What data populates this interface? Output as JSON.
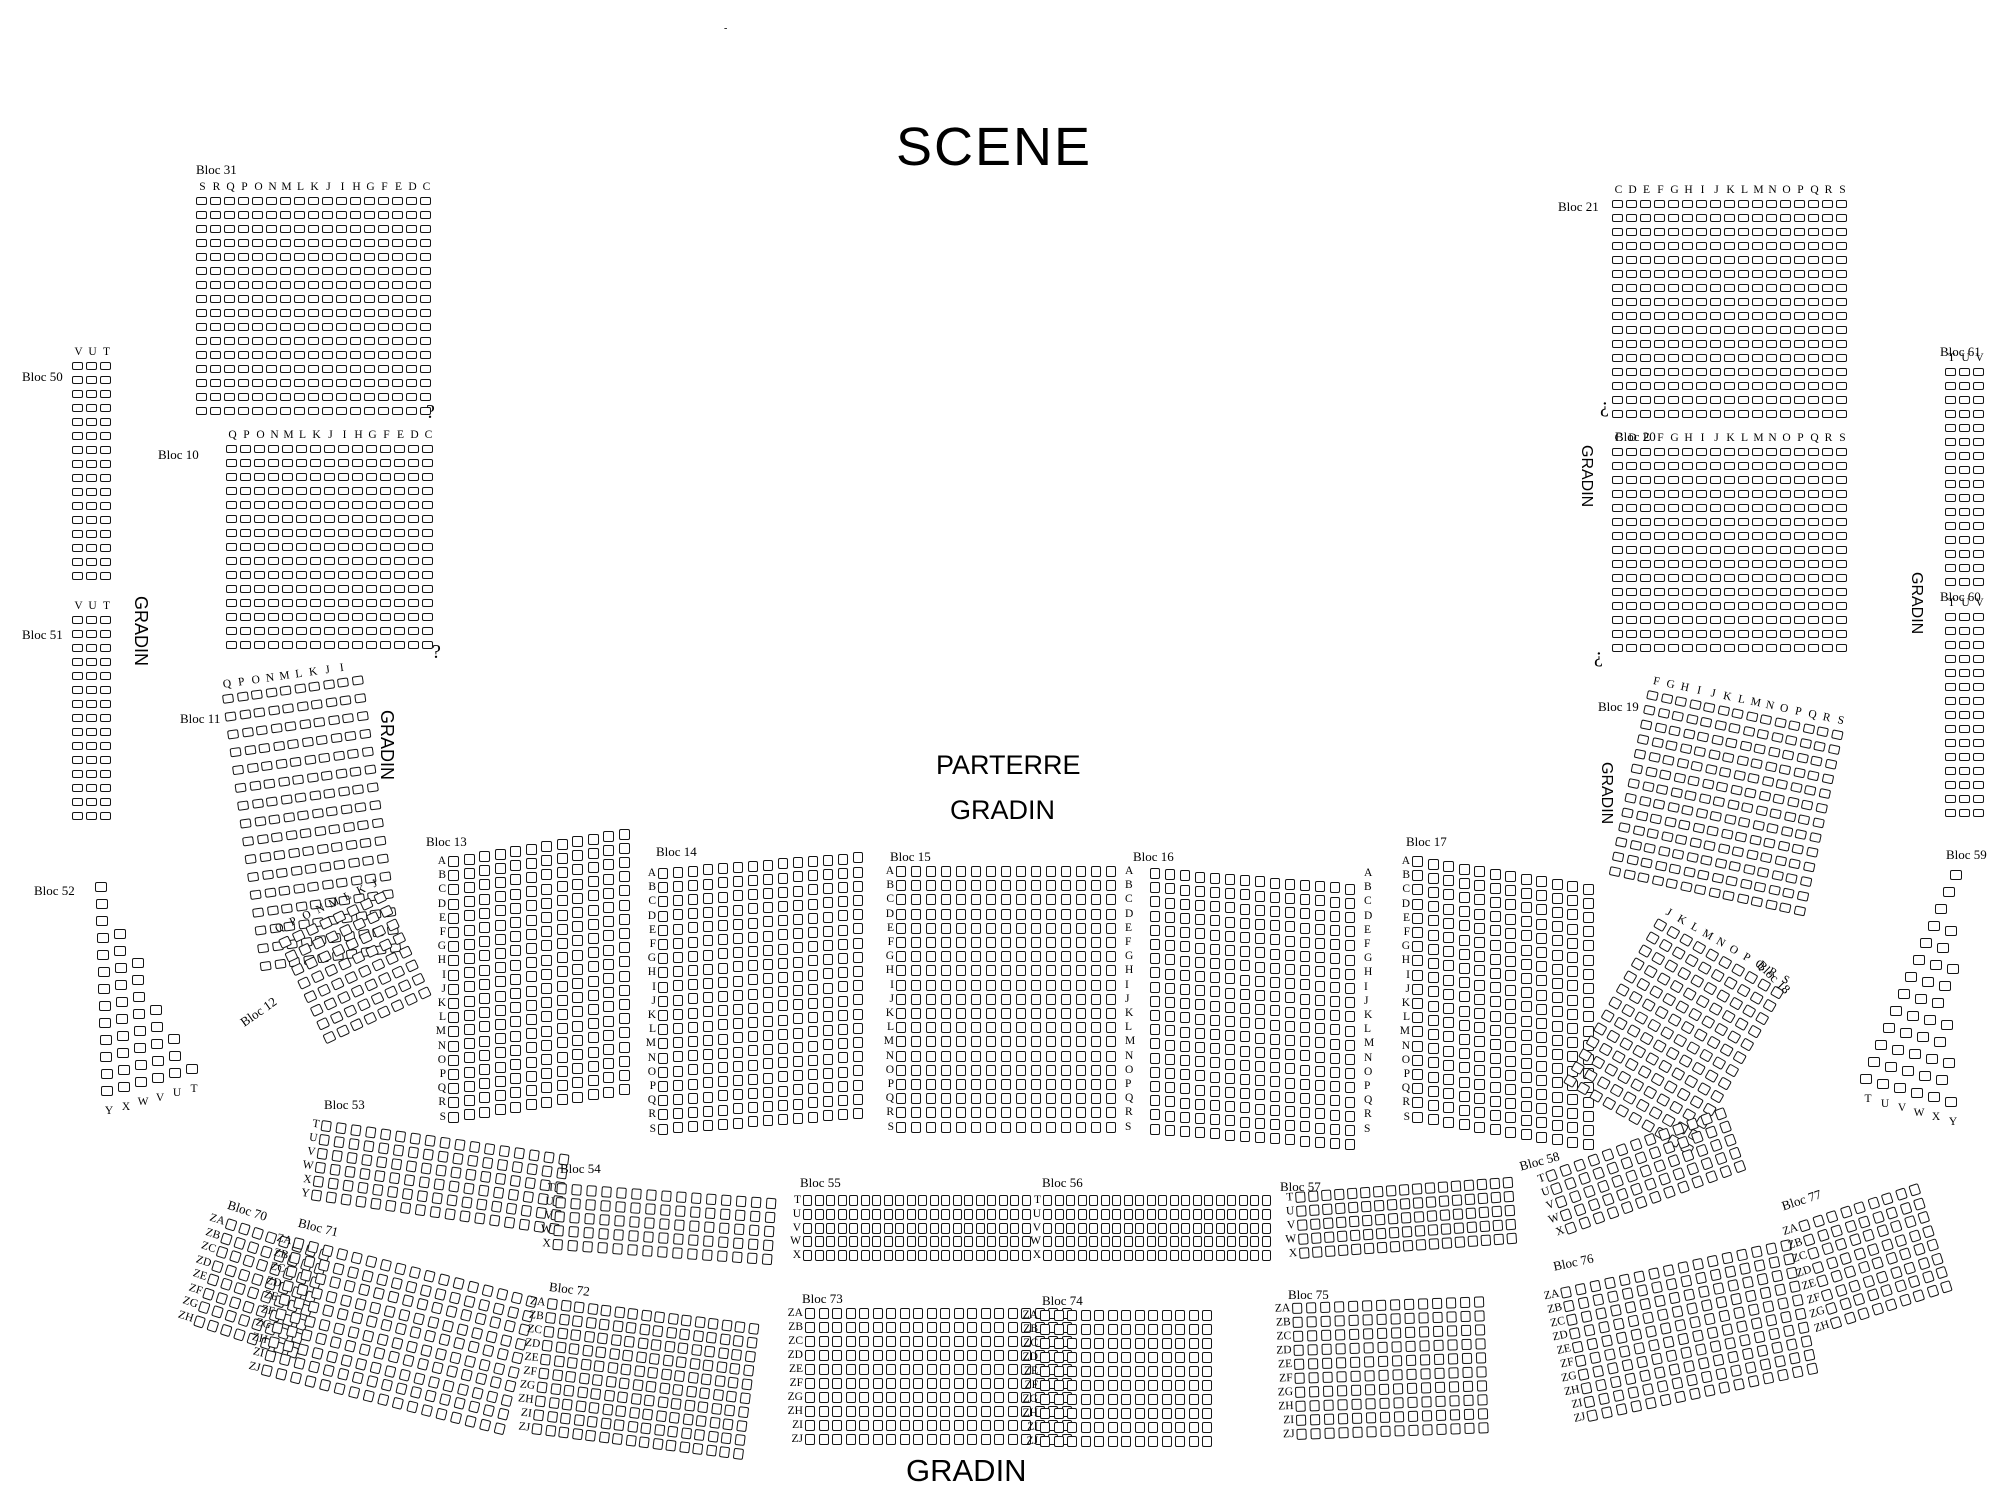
{
  "title": "SCENE",
  "texts": [
    {
      "id": "scene-title",
      "text": "SCENE",
      "x": 896,
      "y": 120,
      "size": 54,
      "sans": true,
      "ls": 2
    },
    {
      "id": "parterre-label",
      "text": "PARTERRE",
      "x": 936,
      "y": 752,
      "size": 27,
      "sans": true
    },
    {
      "id": "gradin-center-label",
      "text": "GRADIN",
      "x": 950,
      "y": 797,
      "size": 27,
      "sans": true
    },
    {
      "id": "gradin-bottom-label",
      "text": "GRADIN",
      "x": 906,
      "y": 1455,
      "size": 31,
      "sans": true
    },
    {
      "id": "gradin-left-vertical-1",
      "text": "GRADIN",
      "x": 150,
      "y": 596,
      "size": 18,
      "sans": true,
      "rot": 90
    },
    {
      "id": "gradin-left-vertical-2",
      "text": "GRADIN",
      "x": 396,
      "y": 710,
      "size": 18,
      "sans": true,
      "rot": 90
    },
    {
      "id": "gradin-right-vertical-1",
      "text": "GRADIN",
      "x": 1594,
      "y": 445,
      "size": 16,
      "sans": true,
      "rot": 90
    },
    {
      "id": "gradin-right-vertical-2",
      "text": "GRADIN",
      "x": 1614,
      "y": 762,
      "size": 16,
      "sans": true,
      "rot": 90
    },
    {
      "id": "gradin-far-right-vertical",
      "text": "GRADIN",
      "x": 1924,
      "y": 572,
      "size": 16,
      "sans": true,
      "rot": 90
    },
    {
      "id": "question-mark-1",
      "text": "?",
      "x": 426,
      "y": 402,
      "size": 20
    },
    {
      "id": "question-mark-2",
      "text": "?",
      "x": 432,
      "y": 642,
      "size": 20
    },
    {
      "id": "inverted-question-mark-1",
      "text": "¿",
      "x": 1600,
      "y": 396,
      "size": 20
    },
    {
      "id": "inverted-question-mark-2",
      "text": "¿",
      "x": 1594,
      "y": 646,
      "size": 20
    },
    {
      "id": "tiny-mark",
      "text": "-",
      "x": 724,
      "y": 24,
      "size": 10
    }
  ],
  "blocks": [
    {
      "id": "bloc-31",
      "label": "Bloc 31",
      "label_x": 196,
      "label_y": 163,
      "x": 196,
      "y": 197,
      "cols": 17,
      "rows": 16,
      "cp": 14,
      "rp": 14,
      "sw": 11,
      "sh": 8,
      "top_letters": [
        "S",
        "R",
        "Q",
        "P",
        "O",
        "N",
        "M",
        "L",
        "K",
        "J",
        "I",
        "H",
        "G",
        "F",
        "E",
        "D",
        "C"
      ]
    },
    {
      "id": "bloc-10",
      "label": "Bloc 10",
      "label_x": 158,
      "label_y": 448,
      "x": 226,
      "y": 445,
      "cols": 15,
      "rows": 15,
      "cp": 14,
      "rp": 14,
      "sw": 11,
      "sh": 8,
      "top_letters": [
        "Q",
        "P",
        "O",
        "N",
        "M",
        "L",
        "K",
        "J",
        "I",
        "H",
        "G",
        "F",
        "E",
        "D",
        "C"
      ]
    },
    {
      "id": "bloc-50",
      "label": "Bloc 50",
      "label_x": 22,
      "label_y": 370,
      "x": 72,
      "y": 362,
      "cols": 3,
      "rows": 16,
      "cp": 14,
      "rp": 14,
      "sw": 11,
      "sh": 8,
      "top_letters": [
        "V",
        "U",
        "T"
      ]
    },
    {
      "id": "bloc-51",
      "label": "Bloc 51",
      "label_x": 22,
      "label_y": 628,
      "x": 72,
      "y": 616,
      "cols": 3,
      "rows": 15,
      "cp": 14,
      "rp": 14,
      "sw": 11,
      "sh": 8,
      "top_letters": [
        "V",
        "U",
        "T"
      ]
    },
    {
      "id": "bloc-52",
      "label": "Bloc 52",
      "label_x": 34,
      "label_y": 884,
      "x": 95,
      "y": 882,
      "rows": 13,
      "base_cols": 1,
      "row_dcols": 0.42,
      "row_dx": 0.5,
      "cp": 17,
      "rp": 17,
      "sw": 12,
      "sh": 10,
      "slope": -4.5,
      "bottom_letters": [
        "Y",
        "X",
        "W",
        "V",
        "U",
        "T"
      ]
    },
    {
      "id": "bloc-11",
      "label": "Bloc 11",
      "label_x": 180,
      "label_y": 712,
      "x": 222,
      "y": 695,
      "cols": 10,
      "rows": 16,
      "cp": 14.5,
      "rp": 18,
      "sw": 11,
      "sh": 9,
      "rot": -8,
      "top_letters": [
        "Q",
        "P",
        "O",
        "N",
        "M",
        "L",
        "K",
        "J",
        "I"
      ]
    },
    {
      "id": "bloc-12",
      "label": "Bloc 12",
      "label_x": 238,
      "label_y": 1018,
      "label_rot": -35,
      "x": 278,
      "y": 940,
      "cols": 8,
      "rows": 8,
      "cp": 15,
      "rp": 15,
      "sw": 11,
      "sh": 10,
      "rot": -25,
      "top_letters": [
        "Q",
        "P",
        "O",
        "N",
        "M",
        "L",
        "K",
        "J"
      ]
    },
    {
      "id": "bloc-13",
      "label": "Bloc 13",
      "label_x": 426,
      "label_y": 835,
      "x": 448,
      "y": 856,
      "cols": 12,
      "rows": 19,
      "cp": 15.5,
      "rp": 14.2,
      "sw": 11,
      "sh": 11,
      "slope": -2.5,
      "lx": -18,
      "left_letters": [
        "A",
        "B",
        "C",
        "D",
        "E",
        "F",
        "G",
        "H",
        "I",
        "J",
        "K",
        "L",
        "M",
        "N",
        "O",
        "P",
        "Q",
        "R",
        "S"
      ]
    },
    {
      "id": "bloc-14",
      "label": "Bloc 14",
      "label_x": 656,
      "label_y": 845,
      "x": 658,
      "y": 868,
      "cols": 14,
      "rows": 19,
      "cp": 15,
      "rp": 14.2,
      "sw": 10,
      "sh": 11,
      "slope": -1.2,
      "lx": -18,
      "left_letters": [
        "A",
        "B",
        "C",
        "D",
        "E",
        "F",
        "G",
        "H",
        "I",
        "J",
        "K",
        "L",
        "M",
        "N",
        "O",
        "P",
        "Q",
        "R",
        "S"
      ]
    },
    {
      "id": "bloc-15",
      "label": "Bloc 15",
      "label_x": 890,
      "label_y": 850,
      "x": 896,
      "y": 866,
      "cols": 15,
      "rows": 19,
      "cp": 15,
      "rp": 14.2,
      "sw": 10,
      "sh": 11,
      "lx": -18,
      "left_letters": [
        "A",
        "B",
        "C",
        "D",
        "E",
        "F",
        "G",
        "H",
        "I",
        "J",
        "K",
        "L",
        "M",
        "N",
        "O",
        "P",
        "Q",
        "R",
        "S"
      ],
      "right_letters": [
        "A",
        "B",
        "C",
        "D",
        "E",
        "F",
        "G",
        "H",
        "I",
        "J",
        "K",
        "L",
        "M",
        "N",
        "O",
        "P",
        "Q",
        "R",
        "S"
      ]
    },
    {
      "id": "bloc-16",
      "label": "Bloc 16",
      "label_x": 1133,
      "label_y": 850,
      "x": 1150,
      "y": 868,
      "cols": 14,
      "rows": 19,
      "cp": 15,
      "rp": 14.2,
      "sw": 10,
      "sh": 11,
      "slope": 1.2,
      "right_letters": [
        "A",
        "B",
        "C",
        "D",
        "E",
        "F",
        "G",
        "H",
        "I",
        "J",
        "K",
        "L",
        "M",
        "N",
        "O",
        "P",
        "Q",
        "R",
        "S"
      ]
    },
    {
      "id": "bloc-17",
      "label": "Bloc 17",
      "label_x": 1406,
      "label_y": 835,
      "x": 1412,
      "y": 856,
      "cols": 12,
      "rows": 19,
      "cp": 15.5,
      "rp": 14.2,
      "sw": 11,
      "sh": 11,
      "slope": 2.5,
      "lx": -18,
      "left_letters": [
        "A",
        "B",
        "C",
        "D",
        "E",
        "F",
        "G",
        "H",
        "I",
        "J",
        "K",
        "L",
        "M",
        "N",
        "O",
        "P",
        "Q",
        "R",
        "S"
      ]
    },
    {
      "id": "bloc-21",
      "label": "Bloc 21",
      "label_x": 1558,
      "label_y": 200,
      "x": 1612,
      "y": 200,
      "cols": 17,
      "rows": 16,
      "cp": 14,
      "rp": 14,
      "sw": 11,
      "sh": 8,
      "top_letters": [
        "C",
        "D",
        "E",
        "F",
        "G",
        "H",
        "I",
        "J",
        "K",
        "L",
        "M",
        "N",
        "O",
        "P",
        "Q",
        "R",
        "S"
      ]
    },
    {
      "id": "bloc-20",
      "label": "Bloc 20",
      "label_x": 1615,
      "label_y": 430,
      "x": 1612,
      "y": 448,
      "cols": 17,
      "rows": 15,
      "cp": 14,
      "rp": 14,
      "sw": 11,
      "sh": 8,
      "top_letters": [
        "C",
        "D",
        "E",
        "F",
        "G",
        "H",
        "I",
        "J",
        "K",
        "L",
        "M",
        "N",
        "O",
        "P",
        "Q",
        "R",
        "S"
      ]
    },
    {
      "id": "bloc-19",
      "label": "Bloc 19",
      "label_x": 1598,
      "label_y": 700,
      "x": 1648,
      "y": 690,
      "cols": 14,
      "rows": 13,
      "cp": 14.5,
      "rp": 15,
      "sw": 11,
      "sh": 9,
      "rot": 12,
      "top_letters": [
        "F",
        "G",
        "H",
        "I",
        "J",
        "K",
        "L",
        "M",
        "N",
        "O",
        "P",
        "Q",
        "R",
        "S"
      ]
    },
    {
      "id": "bloc-18",
      "label": "Bloc 18",
      "label_x": 1764,
      "label_y": 958,
      "label_rot": 45,
      "x": 1658,
      "y": 918,
      "cols": 10,
      "rows": 13,
      "cp": 15,
      "rp": 15,
      "sw": 11,
      "sh": 10,
      "rot": 30,
      "top_letters": [
        "J",
        "K",
        "L",
        "M",
        "N",
        "O",
        "P",
        "Q",
        "R",
        "S"
      ]
    },
    {
      "id": "bloc-61",
      "label": "Bloc 61",
      "label_x": 1940,
      "label_y": 345,
      "x": 1945,
      "y": 368,
      "cols": 3,
      "rows": 16,
      "cp": 14,
      "rp": 14,
      "sw": 11,
      "sh": 8,
      "top_letters": [
        "T",
        "U",
        "V"
      ]
    },
    {
      "id": "bloc-60",
      "label": "Bloc 60",
      "label_x": 1940,
      "label_y": 590,
      "x": 1945,
      "y": 613,
      "cols": 3,
      "rows": 15,
      "cp": 14,
      "rp": 14,
      "sw": 11,
      "sh": 8,
      "top_letters": [
        "T",
        "U",
        "V"
      ]
    },
    {
      "id": "bloc-59",
      "label": "Bloc 59",
      "label_x": 1946,
      "label_y": 848,
      "x": 1950,
      "y": 870,
      "rows": 13,
      "base_cols": 1,
      "row_dcols": 0.42,
      "row_dx": -7.5,
      "cp": 17,
      "rp": 17,
      "sw": 12,
      "sh": 10,
      "slope": 4.5,
      "bottom_letters": [
        "T",
        "U",
        "V",
        "W",
        "X",
        "Y"
      ]
    },
    {
      "id": "bloc-53",
      "label": "Bloc 53",
      "label_x": 324,
      "label_y": 1098,
      "x": 322,
      "y": 1120,
      "cols": 17,
      "rows": 6,
      "cp": 15,
      "rp": 14,
      "sw": 10,
      "sh": 11,
      "rot": 8,
      "lx": -16,
      "left_letters": [
        "T",
        "U",
        "V",
        "W",
        "X",
        "Y"
      ]
    },
    {
      "id": "bloc-54",
      "label": "Bloc 54",
      "label_x": 560,
      "label_y": 1162,
      "x": 557,
      "y": 1183,
      "cols": 15,
      "rows": 5,
      "cp": 15,
      "rp": 14,
      "sw": 10,
      "sh": 11,
      "rot": 4,
      "lx": -16,
      "left_letters": [
        "T",
        "U",
        "V",
        "W",
        "X"
      ]
    },
    {
      "id": "bloc-55",
      "label": "Bloc 55",
      "label_x": 800,
      "label_y": 1176,
      "x": 803,
      "y": 1195,
      "cols": 20,
      "rows": 5,
      "cp": 11.5,
      "rp": 13.8,
      "sw": 9,
      "sh": 11,
      "lx": -16,
      "left_letters": [
        "T",
        "U",
        "V",
        "W",
        "X"
      ]
    },
    {
      "id": "bloc-56",
      "label": "Bloc 56",
      "label_x": 1042,
      "label_y": 1176,
      "x": 1043,
      "y": 1195,
      "cols": 20,
      "rows": 5,
      "cp": 11.5,
      "rp": 13.8,
      "sw": 9,
      "sh": 11,
      "lx": -16,
      "left_letters": [
        "T",
        "U",
        "V",
        "W",
        "X"
      ]
    },
    {
      "id": "bloc-57",
      "label": "Bloc 57",
      "label_x": 1280,
      "label_y": 1180,
      "x": 1295,
      "y": 1192,
      "cols": 17,
      "rows": 5,
      "cp": 13,
      "rp": 14,
      "sw": 10,
      "sh": 11,
      "rot": -4,
      "lx": -16,
      "left_letters": [
        "T",
        "U",
        "V",
        "W",
        "X"
      ]
    },
    {
      "id": "bloc-58",
      "label": "Bloc 58",
      "label_x": 1518,
      "label_y": 1160,
      "label_rot": -15,
      "x": 1545,
      "y": 1172,
      "cols": 13,
      "rows": 5,
      "cp": 15,
      "rp": 14,
      "sw": 10,
      "sh": 11,
      "rot": -20,
      "lx": -16,
      "left_letters": [
        "T",
        "U",
        "V",
        "W",
        "X"
      ]
    },
    {
      "id": "bloc-70",
      "label": "Bloc 70",
      "label_x": 230,
      "label_y": 1198,
      "label_rot": 18,
      "x": 228,
      "y": 1218,
      "cols": 8,
      "rows": 8,
      "cp": 14,
      "rp": 14.5,
      "sw": 10,
      "sh": 11,
      "rot": 18,
      "lx": -26,
      "left_letters": [
        "ZA",
        "ZB",
        "ZC",
        "ZD",
        "ZE",
        "ZF",
        "ZG",
        "ZH"
      ]
    },
    {
      "id": "bloc-71",
      "label": "Bloc 71",
      "label_x": 300,
      "label_y": 1216,
      "label_rot": 14,
      "x": 295,
      "y": 1237,
      "cols": 17,
      "rows": 10,
      "cp": 15,
      "rp": 14.5,
      "sw": 10,
      "sh": 11,
      "rot": 14,
      "lx": -26,
      "left_letters": [
        "ZA",
        "ZB",
        "ZC",
        "ZD",
        "ZE",
        "ZF",
        "ZG",
        "ZH",
        "ZI",
        "ZJ"
      ]
    },
    {
      "id": "bloc-72",
      "label": "Bloc 72",
      "label_x": 550,
      "label_y": 1280,
      "label_rot": 7,
      "x": 548,
      "y": 1298,
      "cols": 16,
      "rows": 10,
      "cp": 13.5,
      "rp": 14,
      "sw": 10,
      "sh": 11,
      "rot": 7,
      "lx": -26,
      "left_letters": [
        "ZA",
        "ZB",
        "ZC",
        "ZD",
        "ZE",
        "ZF",
        "ZG",
        "ZH",
        "ZI",
        "ZJ"
      ]
    },
    {
      "id": "bloc-73",
      "label": "Bloc 73",
      "label_x": 802,
      "label_y": 1292,
      "x": 805,
      "y": 1308,
      "cols": 20,
      "rows": 10,
      "cp": 13.5,
      "rp": 14,
      "sw": 10,
      "sh": 11,
      "lx": -26,
      "left_letters": [
        "ZA",
        "ZB",
        "ZC",
        "ZD",
        "ZE",
        "ZF",
        "ZG",
        "ZH",
        "ZI",
        "ZJ"
      ]
    },
    {
      "id": "bloc-74",
      "label": "Bloc 74",
      "label_x": 1042,
      "label_y": 1294,
      "x": 1040,
      "y": 1310,
      "cols": 13,
      "rows": 10,
      "cp": 13.5,
      "rp": 14,
      "sw": 10,
      "sh": 11,
      "lx": -26,
      "left_letters": [
        "ZA",
        "ZB",
        "ZC",
        "ZD",
        "ZE",
        "ZF",
        "ZG",
        "ZH",
        "ZI",
        "ZJ"
      ]
    },
    {
      "id": "bloc-75",
      "label": "Bloc 75",
      "label_x": 1288,
      "label_y": 1288,
      "x": 1292,
      "y": 1303,
      "cols": 14,
      "rows": 10,
      "cp": 14,
      "rp": 14,
      "sw": 10,
      "sh": 11,
      "rot": -2,
      "lx": -26,
      "left_letters": [
        "ZA",
        "ZB",
        "ZC",
        "ZD",
        "ZE",
        "ZF",
        "ZG",
        "ZH",
        "ZI",
        "ZJ"
      ]
    },
    {
      "id": "bloc-76",
      "label": "Bloc 76",
      "label_x": 1552,
      "label_y": 1260,
      "label_rot": -12,
      "x": 1560,
      "y": 1288,
      "cols": 16,
      "rows": 10,
      "cp": 15,
      "rp": 14,
      "sw": 10,
      "sh": 11,
      "rot": -12,
      "lx": -26,
      "left_letters": [
        "ZA",
        "ZB",
        "ZC",
        "ZD",
        "ZE",
        "ZF",
        "ZG",
        "ZH",
        "ZI",
        "ZJ"
      ]
    },
    {
      "id": "bloc-77",
      "label": "Bloc 77",
      "label_x": 1780,
      "label_y": 1200,
      "label_rot": -18,
      "x": 1798,
      "y": 1222,
      "cols": 9,
      "rows": 8,
      "cp": 14.5,
      "rp": 14.5,
      "sw": 10,
      "sh": 11,
      "rot": -18,
      "lx": -26,
      "left_letters": [
        "ZA",
        "ZB",
        "ZC",
        "ZD",
        "ZE",
        "ZF",
        "ZG",
        "ZH"
      ]
    }
  ]
}
